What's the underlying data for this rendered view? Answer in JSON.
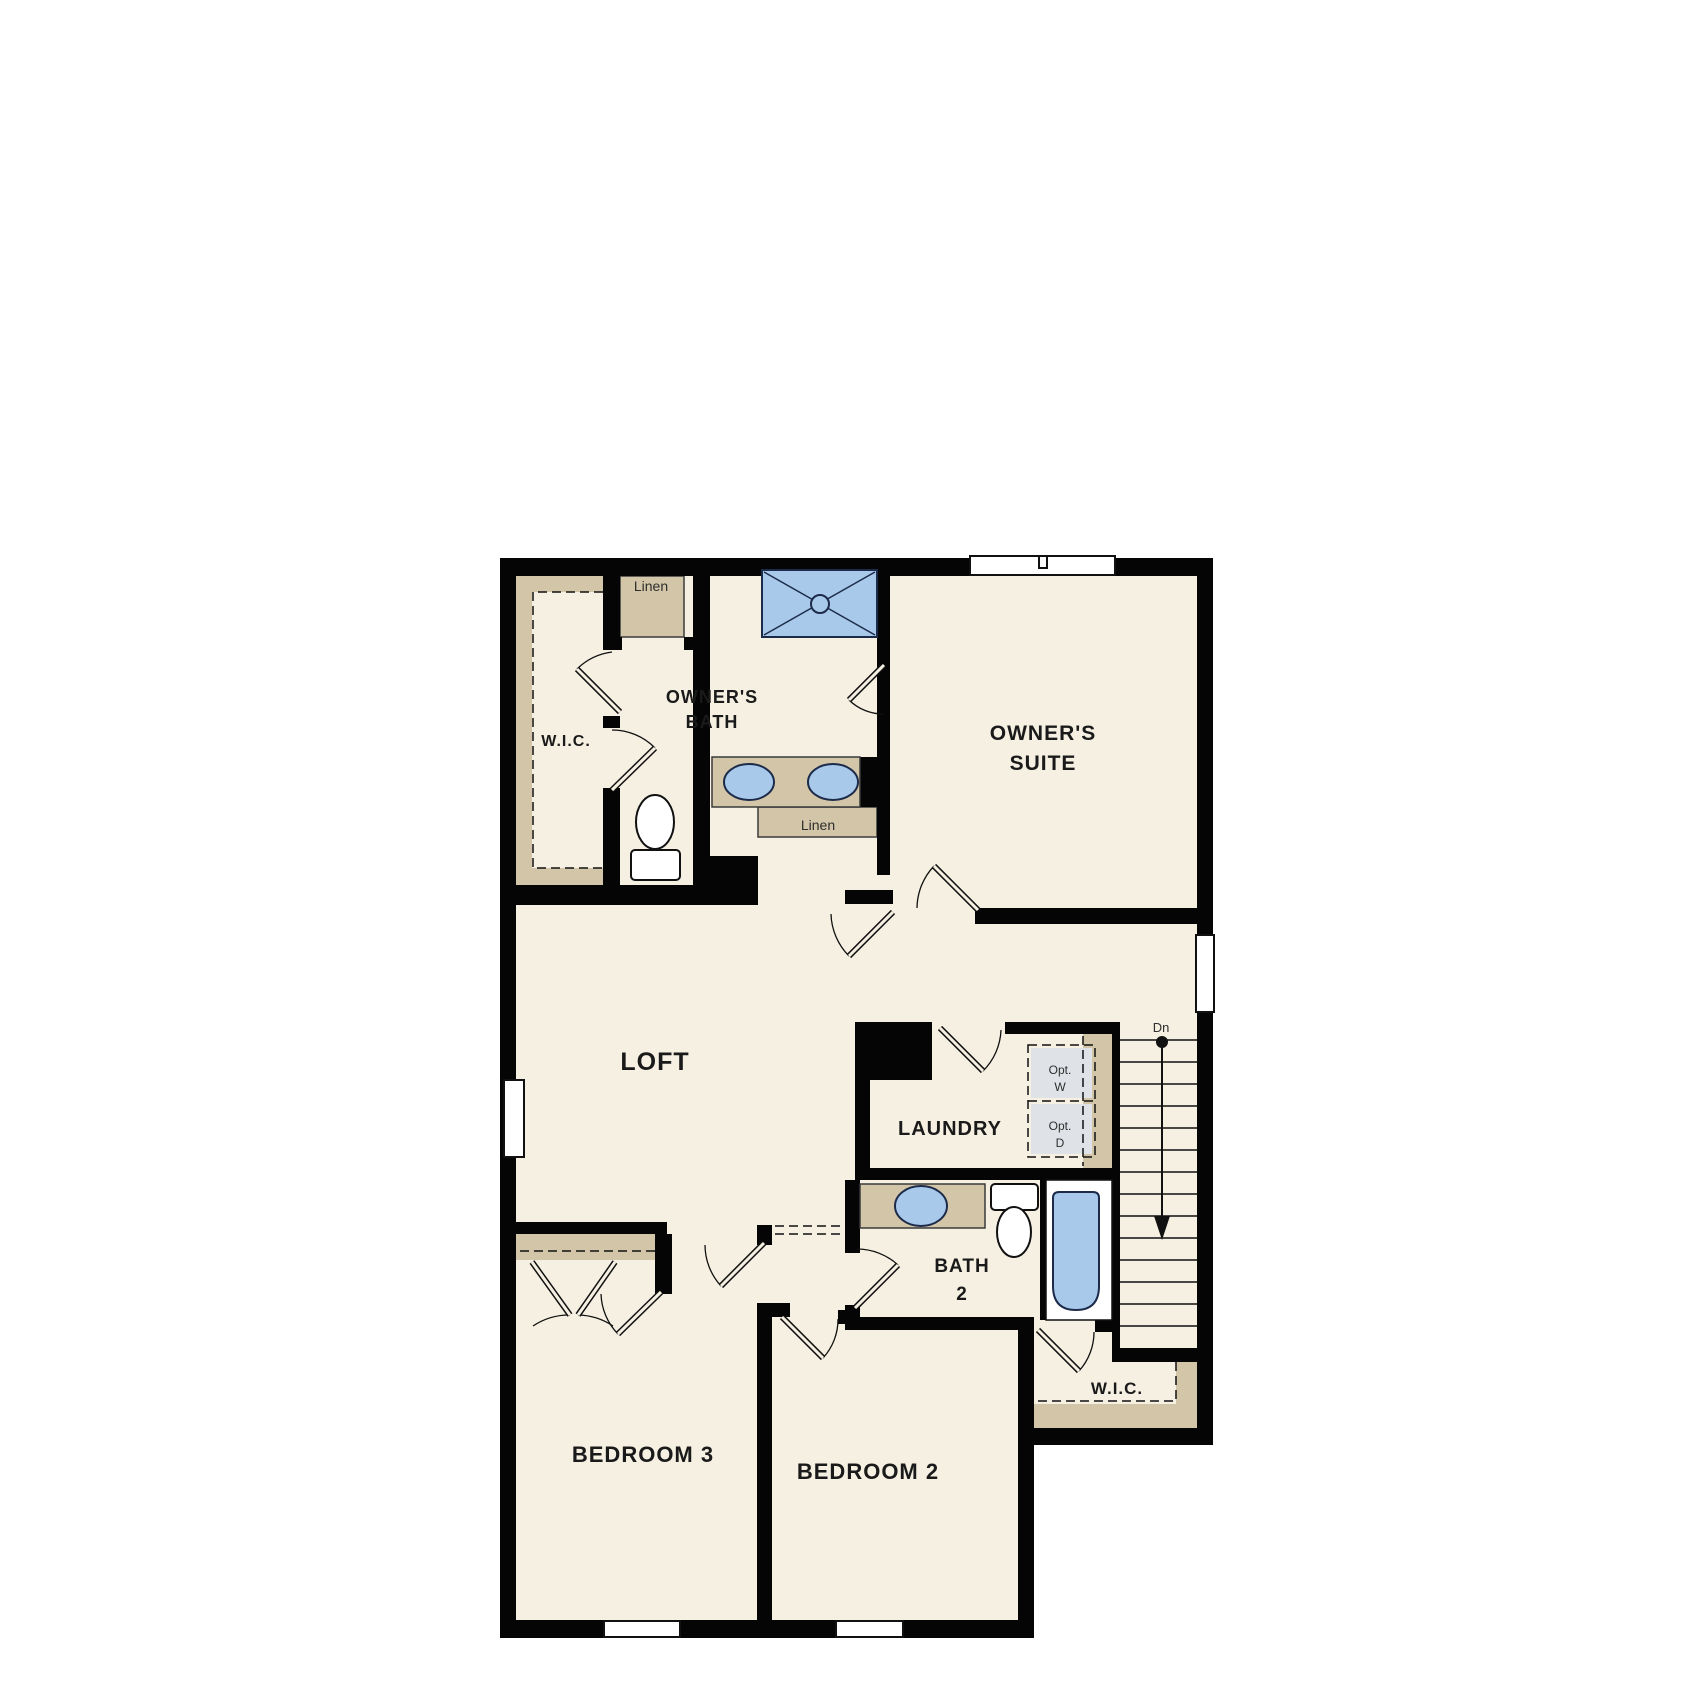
{
  "floor_plan": {
    "colors": {
      "floor": "#f5f0e2",
      "wall": "#050505",
      "closet_tan": "#d2c5a8",
      "fixture_blue": "#a9c9ea",
      "appliance_gray": "#dfe2e7"
    },
    "labels": {
      "wic_upper": "W.I.C.",
      "linen_upper": "Linen",
      "owners_bath_line1": "OWNER'S",
      "owners_bath_line2": "BATH",
      "owners_suite_line1": "OWNER'S",
      "owners_suite_line2": "SUITE",
      "linen_mid": "Linen",
      "loft": "LOFT",
      "laundry": "LAUNDRY",
      "opt_washer_line1": "Opt.",
      "opt_washer_line2": "W",
      "opt_dryer_line1": "Opt.",
      "opt_dryer_line2": "D",
      "stairs_down": "Dn",
      "bath2_line1": "BATH",
      "bath2_line2": "2",
      "bedroom3": "BEDROOM 3",
      "bedroom2": "BEDROOM 2",
      "wic_lower": "W.I.C."
    },
    "fixtures": [
      "shower-pan",
      "double-vanity-sinks",
      "toilet-owners-bath",
      "toilet-bath2",
      "bathtub",
      "bath2-sink",
      "optional-washer",
      "optional-dryer",
      "stairs-down-arrow"
    ]
  }
}
